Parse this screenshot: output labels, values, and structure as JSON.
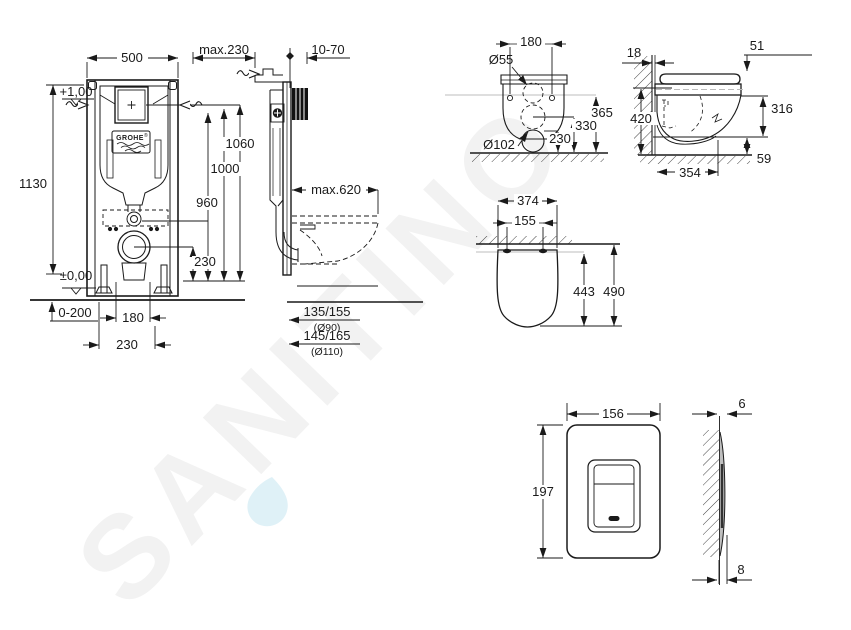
{
  "watermark": {
    "text": "SANITINO",
    "text_color": "#f2f2f2",
    "droplet_color": "#d9eef6"
  },
  "brand": {
    "logo": "GROHE"
  },
  "frame_front": {
    "width": "500",
    "height_total": "1130",
    "level_top": "+1,00",
    "level_zero": "±0,00",
    "h_plate_top": "1060",
    "h_plate": "1000",
    "h_inlet": "960",
    "h_outlet": "230",
    "feet_range": "0-200",
    "bolt_span": "180",
    "pipe_span": "230"
  },
  "frame_side": {
    "depth": "max.230",
    "wall_finish": "10-70",
    "bowl_max": "max.620",
    "drain1": "135/155",
    "drain1_dia": "(Ø90)",
    "drain2": "145/165",
    "drain2_dia": "(Ø110)"
  },
  "wc_rear": {
    "hole_span": "180",
    "inlet_dia": "Ø55",
    "h_inlet": "365",
    "h_mid": "330",
    "h_outlet": "230",
    "outlet_dia": "Ø102"
  },
  "wc_side": {
    "wall": "18",
    "seat_thickness": "51",
    "height": "420",
    "rim_height": "316",
    "depth": "354",
    "clearance": "59"
  },
  "wc_top": {
    "width": "374",
    "hinge_span": "155",
    "depth_seat": "443",
    "depth_total": "490"
  },
  "plate_front": {
    "width": "156",
    "height": "197"
  },
  "plate_side": {
    "thickness": "6",
    "depth": "8"
  }
}
